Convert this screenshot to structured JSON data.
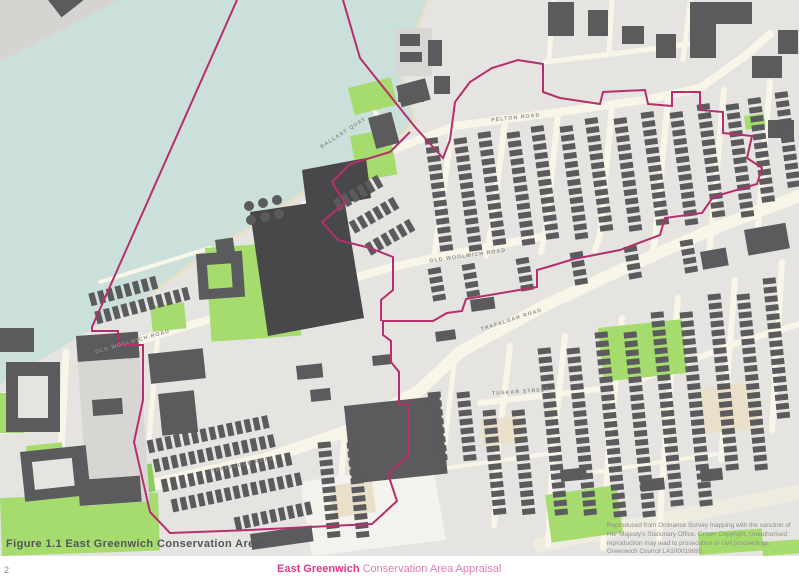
{
  "page": {
    "number": "2"
  },
  "footer": {
    "title_bold": "East Greenwich",
    "title_rest": " Conservation Area Appraisal"
  },
  "figure": {
    "caption": "Figure 1.1 East Greenwich Conservation Area"
  },
  "copyright": {
    "lines": [
      "Reproduced from Ordnance Survey mapping with the sanction of",
      "Her Majesty's Stationary Office. Crown Copyright. Unauthorised",
      "reproduction may lead to prosecution or civil proceedings.",
      "Greenwich Council LA100019695."
    ]
  },
  "map": {
    "area_name": "East Greenwich Conservation Area",
    "street_labels": [
      {
        "text": "BALLAST QUAY",
        "x": 344,
        "y": 134,
        "angle": -33
      },
      {
        "text": "PELTON ROAD",
        "x": 516,
        "y": 119,
        "angle": -6
      },
      {
        "text": "OLD WOOLWICH ROAD",
        "x": 133,
        "y": 343,
        "angle": -16
      },
      {
        "text": "OLD WOOLWICH ROAD",
        "x": 468,
        "y": 257,
        "angle": -8
      },
      {
        "text": "TRAFALGAR ROAD",
        "x": 243,
        "y": 466,
        "angle": -12
      },
      {
        "text": "TRAFALGAR ROAD",
        "x": 512,
        "y": 321,
        "angle": -18
      },
      {
        "text": "TUSKAR STREET",
        "x": 521,
        "y": 393,
        "angle": -4
      }
    ],
    "colors": {
      "water": "#cbdfdb",
      "land": "#e6e4e0",
      "wharf": "#d6d4d1",
      "road": "#f9f5e8",
      "wide_road": "#eeebe1",
      "building": "#5b5b5e",
      "building_dark": "#48484b",
      "light_slab": "#d8d6d2",
      "green": "#a6dc6d",
      "green_dark": "#8ccb5e",
      "beach": "#e8dfc5",
      "beige": "#eadfc8",
      "white_lot": "#f4f2ed",
      "boundary": "#b62e6d",
      "label_text": "#8f8f8a"
    }
  }
}
